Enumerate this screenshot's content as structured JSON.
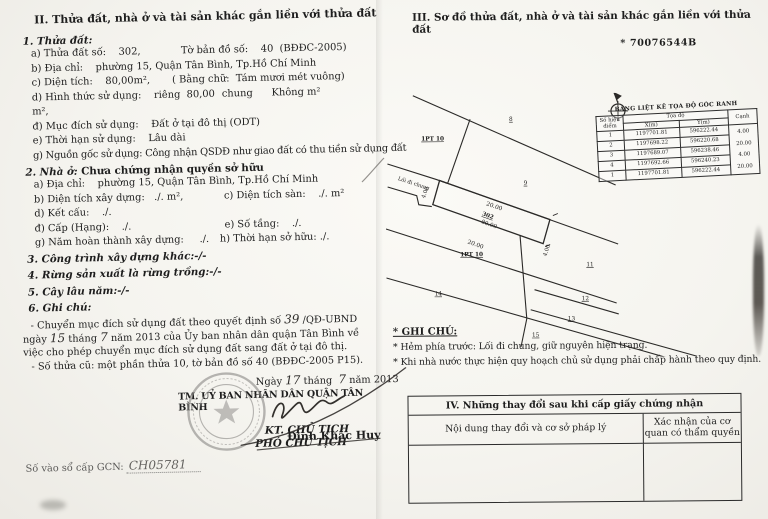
{
  "doc": {
    "left": {
      "title": "II. Thửa đất, nhà ở và tài sản khác gắn liền với thửa đất",
      "land": {
        "heading": "1. Thửa đất:",
        "row_a": "a) Thửa đất số:    302,",
        "row_a_right": "Tờ bản đồ số:    40  (BĐĐC-2005)",
        "row_b": "b) Địa chỉ:    phường 15, Quận Tân Bình, Tp.Hồ Chí Minh",
        "row_c": "c) Diện tích:    80,00m²,       ( Bằng chữ:  Tám mươi mét vuông)",
        "row_d": "d) Hình thức sử dụng:    riêng  80,00 m²,",
        "row_d_right": "chung      Không m²",
        "row_dd": "đ) Mục đích sử dụng:    Đất ở tại đô thị (ODT)",
        "row_e": "e) Thời hạn sử dụng:    Lâu dài",
        "row_g": "g) Nguồn gốc sử dụng:  Công nhận QSDĐ như giao đất có thu tiền sử dụng đất"
      },
      "house": {
        "heading_label": "2. Nhà ở:",
        "heading_value": " Chưa chứng nhận quyền sở hữu",
        "row_a": "a) Địa chỉ:    phường 15, Quận Tân Bình, Tp.Hồ Chí Minh",
        "row_b": "b) Diện tích xây dựng:   ./. m²,",
        "row_c": "c) Diện tích sàn:    ./. m²",
        "row_d": "d) Kết cấu:    ./.",
        "row_dd": "đ) Cấp (Hạng):    ./.",
        "row_e": "e) Số tầng:    ./.",
        "row_g": "g) Năm hoàn thành xây dựng:     ./.",
        "row_h": "h) Thời hạn sở hữu: ./."
      },
      "item3": "3. Công trình xây dựng khác:-/-",
      "item4": "4. Rừng sản xuất là rừng trồng:-/-",
      "item5": "5. Cây lâu năm:-/-",
      "item6": "6. Ghi chú:",
      "note": {
        "p1_a": "- Chuyển mục đích sử dụng đất theo quyết định số ",
        "p1_no": "39",
        "p1_b": " /QĐ-UBND ngày ",
        "p1_day": "15",
        "p1_c": " tháng ",
        "p1_month": "7",
        "p1_d": " năm 2013 của Ủy ban nhân dân quận Tân Bình về việc cho phép chuyển mục đích sử dụng đất sang đất ở tại đô thị.",
        "p2": "- Số thửa cũ: một phần thửa 10, tờ bản đồ số 40 (BĐĐC-2005 P15)."
      },
      "sign": {
        "date_a": "Ngày ",
        "date_day": "17",
        "date_b": " tháng  ",
        "date_month": "7",
        "date_c": " năm 2013",
        "committee": "TM. UỶ BAN NHÂN DÂN QUẬN TÂN BÌNH",
        "kt": "KT. CHỦ TỊCH",
        "pho": "PHÓ CHỦ TỊCH",
        "name": "Đinh Khắc Huy"
      },
      "book_label": "Số vào sổ cấp GCN: ",
      "book_value": "CH05781"
    },
    "right": {
      "title": "III. Sơ đồ thửa đất, nhà ở và tài sản khác gắn liền với thửa đất",
      "serial": "* 70076544B",
      "coord_table": {
        "title": "BẢNG LIỆT KÊ TỌA ĐỘ GÓC RANH",
        "col_point": "Số hiệu điểm",
        "col_coord": "Tọa độ",
        "col_x": "X(m)",
        "col_y": "Y(m)",
        "col_edge": "Cạnh",
        "rows": [
          {
            "pt": "1",
            "x": "1197701.81",
            "y": "596222.44"
          },
          {
            "pt": "2",
            "x": "1197698.22",
            "y": "596220.68"
          },
          {
            "pt": "3",
            "x": "1197689.07",
            "y": "596238.46"
          },
          {
            "pt": "4",
            "x": "1197692.66",
            "y": "596240.23"
          },
          {
            "pt": "1",
            "x": "1197701.81",
            "y": "596222.44"
          }
        ],
        "edges": [
          "4.00",
          "20.00",
          "4.00",
          "20.00"
        ]
      },
      "diagram": {
        "path_label": "Lối đi chung",
        "pt10_upper": "1PT 10",
        "pt10_lower": "1PT 10",
        "parcel_no": "302",
        "parcel_area": "80.00",
        "dim_top": "20.00",
        "dim_bottom": "20.00",
        "dim_left": "4.00",
        "dim_right": "4.00",
        "n8": "8",
        "n9": "9",
        "n11": "11",
        "n12": "12",
        "n13": "13",
        "n14": "14",
        "n15": "15"
      },
      "notes": {
        "title": "* GHI CHÚ:",
        "line1": "* Hẻm  phía trước: Lối đi chung, giữ nguyên hiện trạng.",
        "line2": "* Khi nhà nước thực hiện quy hoạch chủ sử dụng phải chấp hành theo quy định."
      },
      "table4": {
        "title": "IV. Những thay đổi sau khi cấp giấy chứng nhận",
        "col1": "Nội dung thay đổi và cơ sở pháp lý",
        "col2": "Xác nhận của cơ quan có thẩm quyền"
      }
    }
  }
}
